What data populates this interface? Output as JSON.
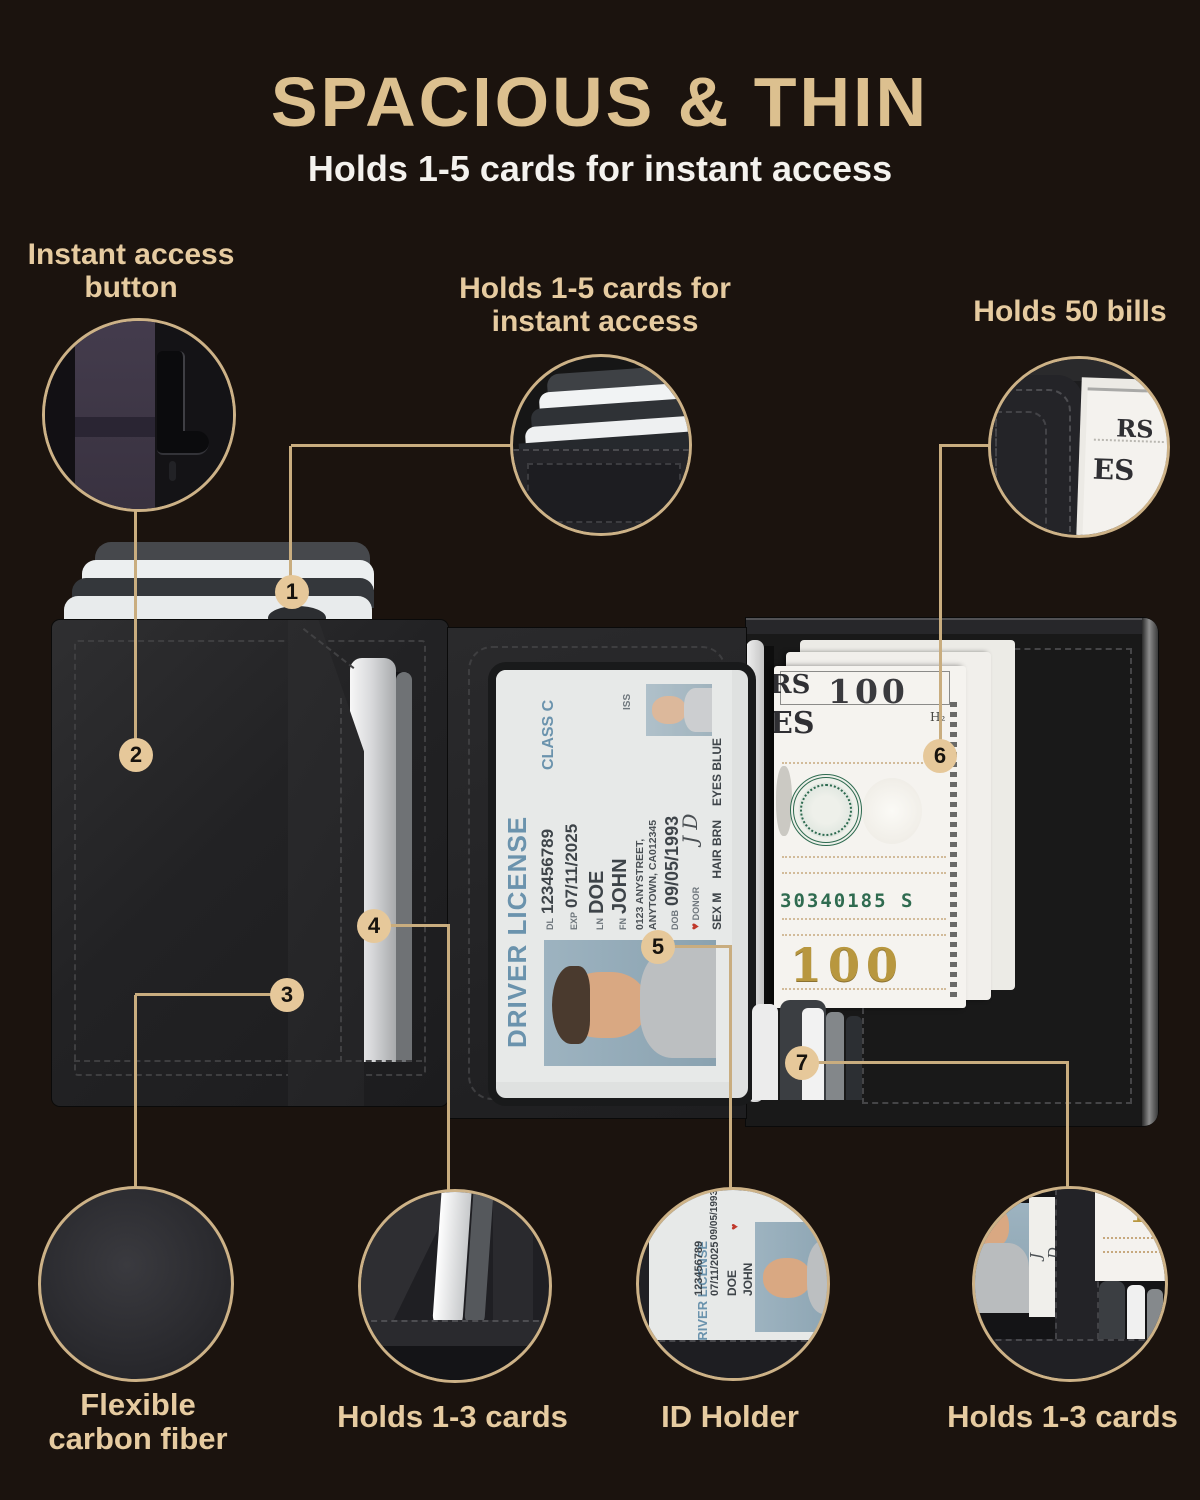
{
  "header": {
    "title": "SPACIOUS & THIN",
    "subtitle": "Holds 1-5 cards for instant access"
  },
  "callouts": {
    "instant_access": {
      "line1": "Instant access",
      "line2": "button"
    },
    "holds_1_5": {
      "line1": "Holds 1-5 cards for",
      "line2": "instant access"
    },
    "holds_50_bills": "Holds 50 bills",
    "flexible": {
      "line1": "Flexible",
      "line2": "carbon fiber"
    },
    "holds_1_3_left": "Holds 1-3 cards",
    "id_holder": "ID Holder",
    "holds_1_3_right": "Holds 1-3 cards"
  },
  "badges": {
    "b1": "1",
    "b2": "2",
    "b3": "3",
    "b4": "4",
    "b5": "5",
    "b6": "6",
    "b7": "7"
  },
  "license": {
    "title": "DRIVER LICENSE",
    "class": "CLASS C",
    "dl_label": "DL",
    "dl_value": "123456789",
    "exp_label": "EXP",
    "exp_value": "07/11/2025",
    "ln_label": "LN",
    "ln_value": "DOE",
    "fn_label": "FN",
    "fn_value": "JOHN",
    "address_line1": "0123 ANYSTREET,",
    "address_line2": "ANYTOWN, CA012345",
    "dob_label": "DOB",
    "dob_value": "09/05/1993",
    "donor": "DONOR",
    "donor_heart": "♥",
    "sex": "SEX M",
    "hair": "HAIR BRN",
    "eyes": "EYES BLUE",
    "iss": "ISS",
    "signature": "J D"
  },
  "bill": {
    "fragment_rs": "RS",
    "fragment_es": "ES",
    "denomination": "100",
    "h2_mark": "H₂",
    "serial": "30340185 S",
    "denomination_gold": "100",
    "fragment_gold": "10"
  },
  "colors": {
    "background": "#1b130e",
    "accent_gold": "#dcc08f",
    "label_tan": "#e6cba0",
    "connector": "#c9ad7f",
    "badge_fill": "#e6c89a",
    "license_blue": "#6b93ad",
    "seal_green": "#2d6a4f",
    "bill_gold": "#b8973f"
  }
}
